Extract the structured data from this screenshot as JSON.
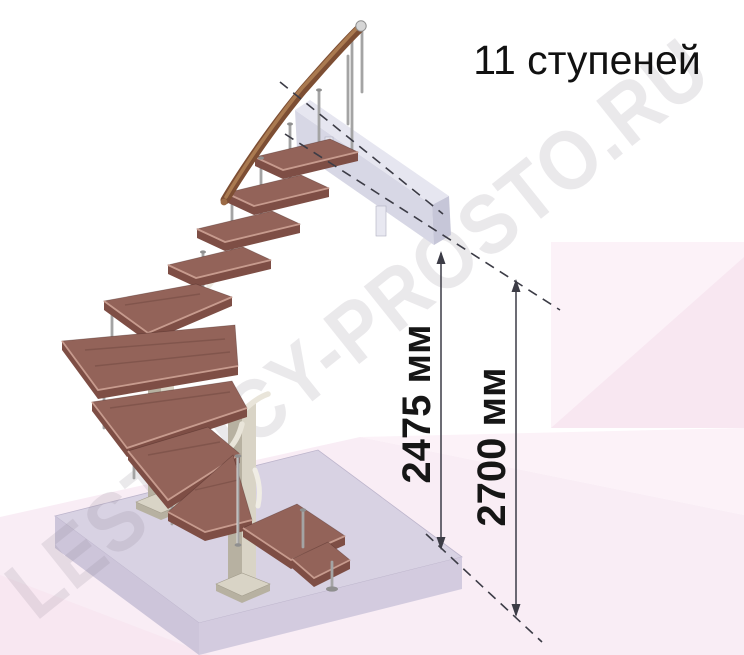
{
  "annotation": {
    "steps_label": "11 ступеней",
    "steps_count": 11,
    "dim_inner_label": "2475 мм",
    "dim_outer_label": "2700 мм"
  },
  "watermark": {
    "text": "LESTNICY-PROSTO.RU"
  },
  "colors": {
    "wood_top": "#936359",
    "wood_front": "#7e4e45",
    "wood_highlight": "#c79b8e",
    "handrail": "#7d4e33",
    "handrail_light": "#aa7a50",
    "metal_rod": "#a4a4a4",
    "post": "#d9d4c6",
    "post_shadow": "#b7b1a1",
    "floor_top": "#d8d2e3",
    "floor_left": "#cdc5da",
    "floor_right": "#d3cbdf",
    "landing_front": "#d5d5e4",
    "landing_top": "#e6e6f0",
    "landing_end": "#c6c6d8",
    "pink": "#f9edf5",
    "pink_deep": "#f8e7f1",
    "pink_lite": "#fcf2f8",
    "dim_line": "#3c3c46",
    "watermark_color": "#8a8090",
    "text": "#111111"
  }
}
